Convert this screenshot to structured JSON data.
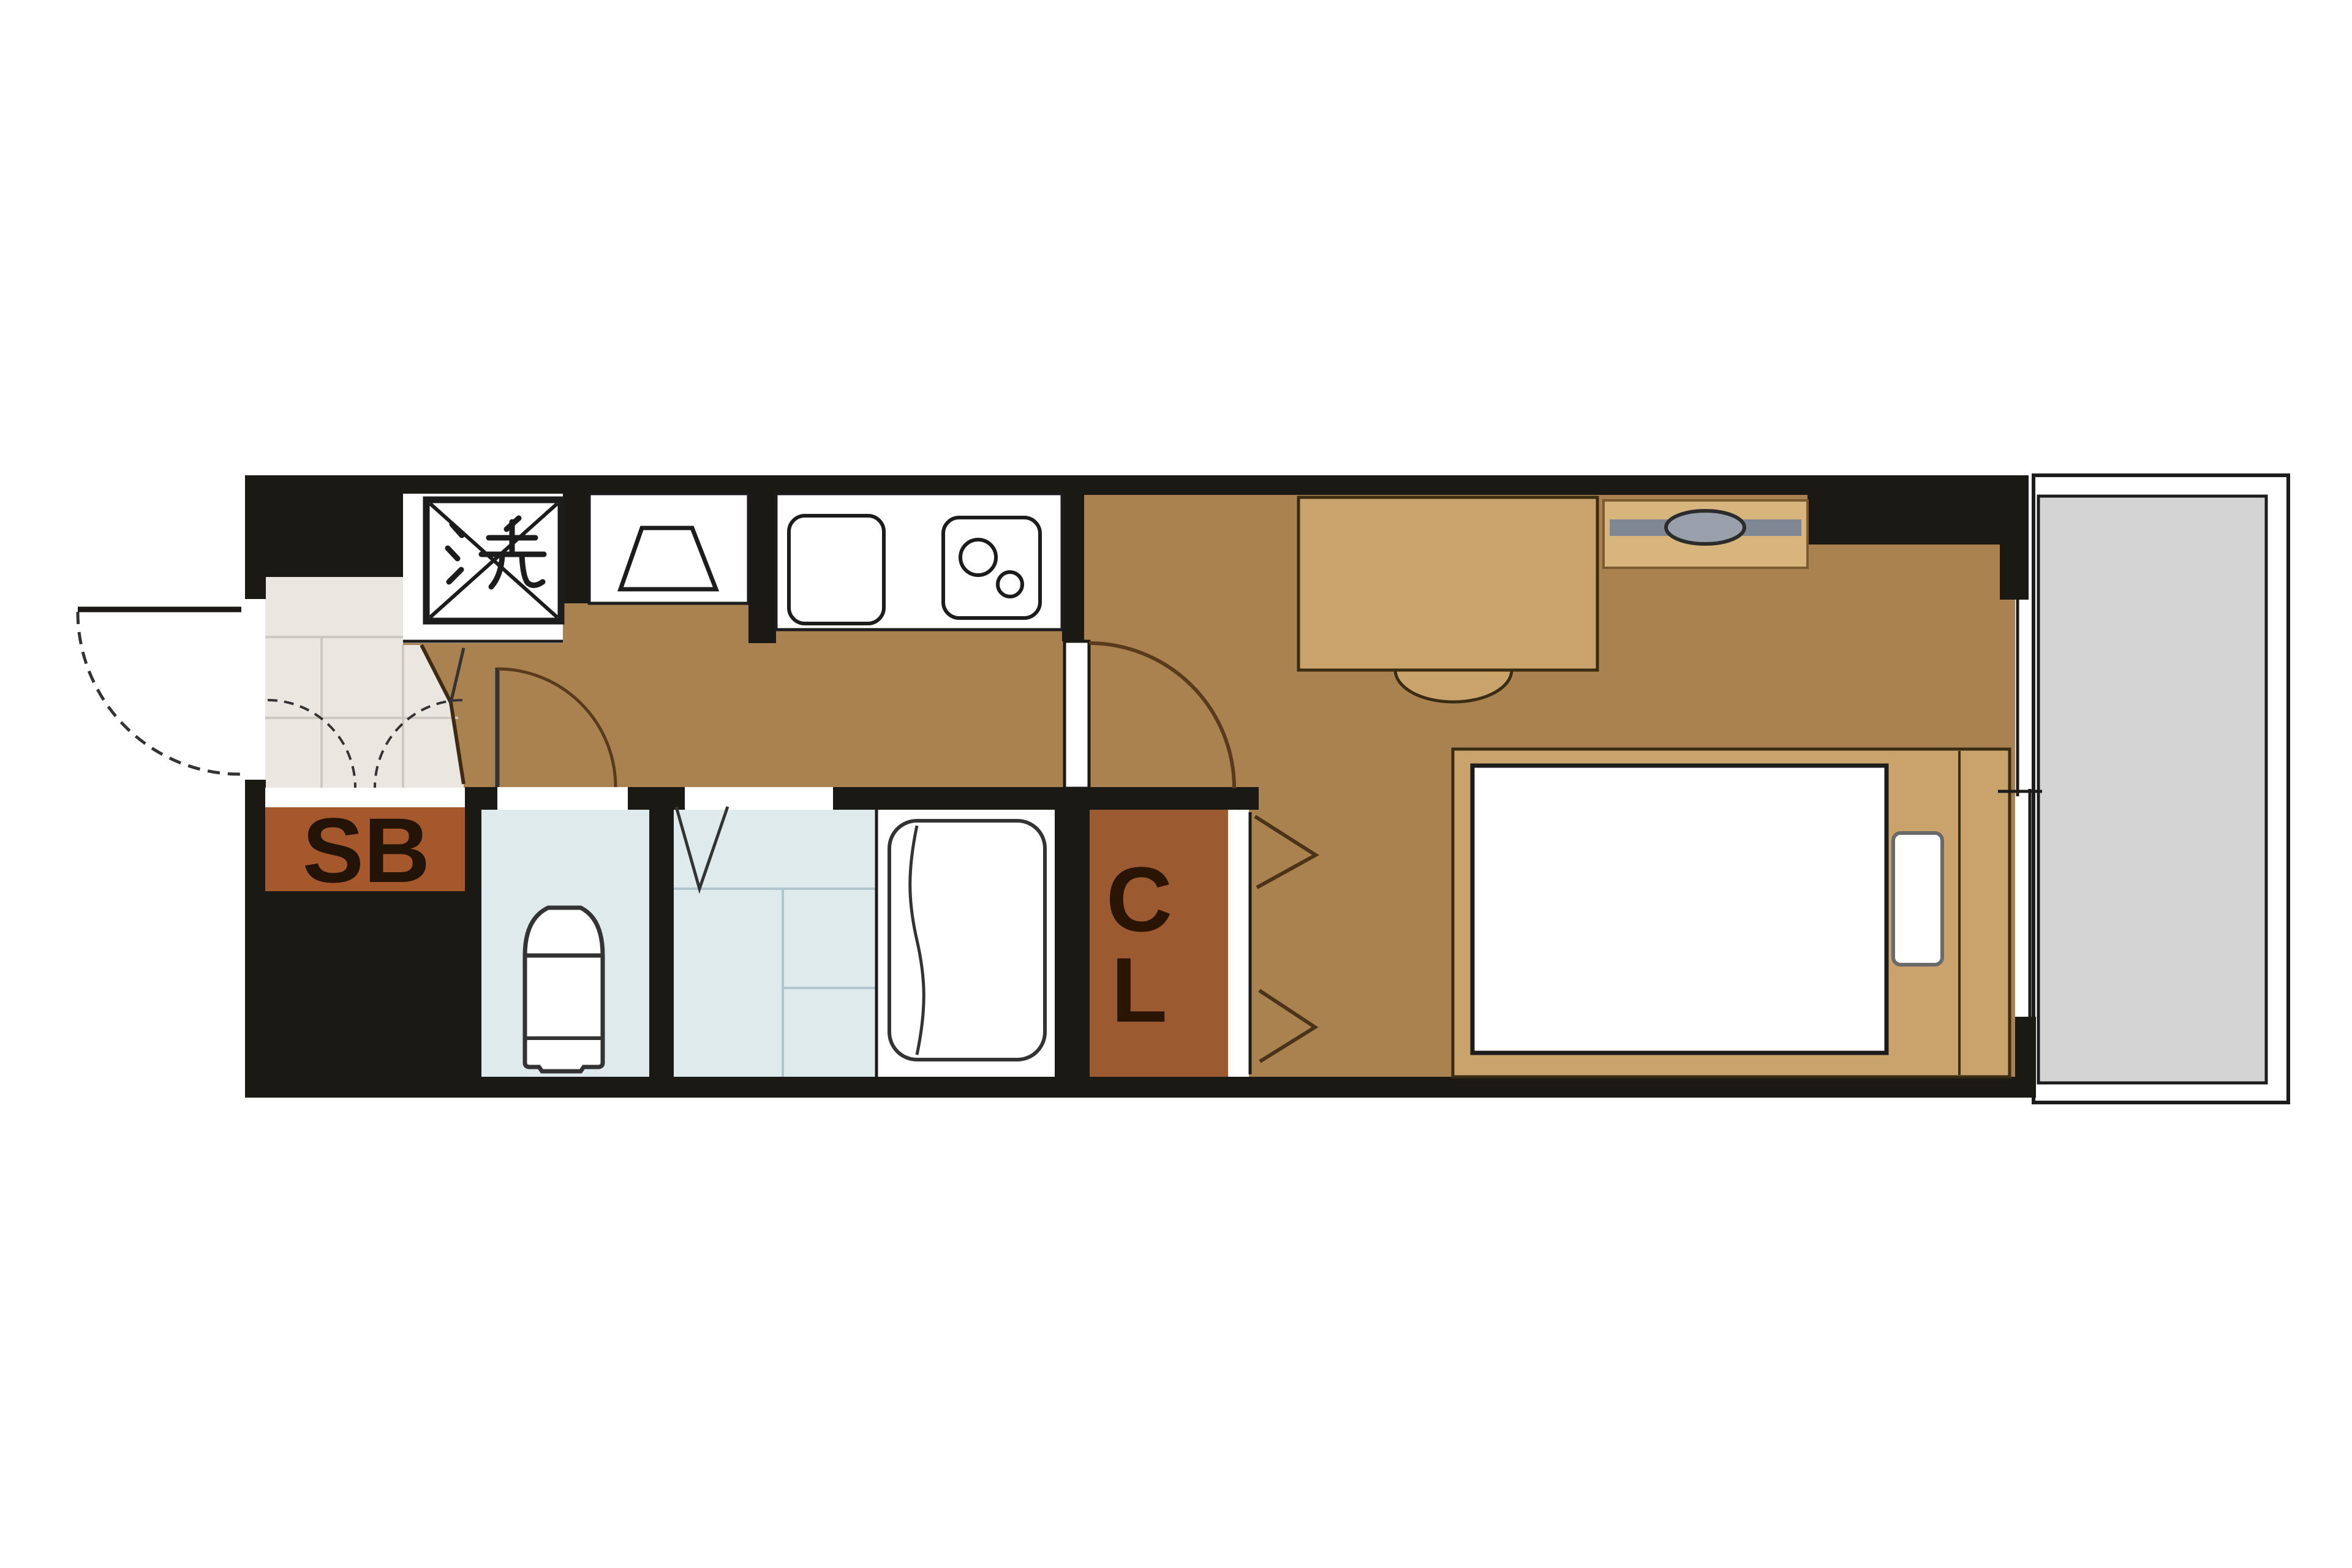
{
  "plan": {
    "type": "japanese-apartment-floor-plan",
    "labels": {
      "washer": "洗",
      "shoe_box": "SB",
      "closet": "CL",
      "closet_letters": [
        "C",
        "L"
      ]
    },
    "rooms": [
      "entrance-genkan",
      "hallway-kitchen",
      "toilet-room",
      "bathroom",
      "closet",
      "main-room",
      "balcony"
    ],
    "fixtures": [
      "washing-machine-space",
      "range-space",
      "kitchen-sink",
      "gas-stove",
      "shoe-box",
      "toilet",
      "bathtub",
      "desk",
      "chair",
      "tv-board",
      "bed",
      "pillow",
      "sliding-window"
    ]
  },
  "colors": {
    "wall": "#1b1914",
    "floor": "#a9824f",
    "furniture": "#c9a36b",
    "furniture_border": "#3a2c12",
    "tv_board": "#d7b57c",
    "tv_board_border": "#7a5a2e",
    "tv_bar": "#7f8793",
    "tv_oval": "#99a0ac",
    "tv_oval_border": "#2c2c2c",
    "genkan": "#eae7e0",
    "tile_line": "#cdc9c0",
    "white": "#ffffff",
    "sb": "#a4582c",
    "sb_text": "#231407",
    "cl": "#9c5a30",
    "cl_text": "#2a1505",
    "bath": "#dfeaec",
    "bath_line": "#aec6cc",
    "balcony": "#d4d4d4",
    "outline": "#1c1c1c",
    "door_arc": "#5a3a1c",
    "dark_line": "#333333",
    "boundary": "#3f2a14",
    "chevron": "#4a3318",
    "pillow_border": "#6a6a6a"
  }
}
